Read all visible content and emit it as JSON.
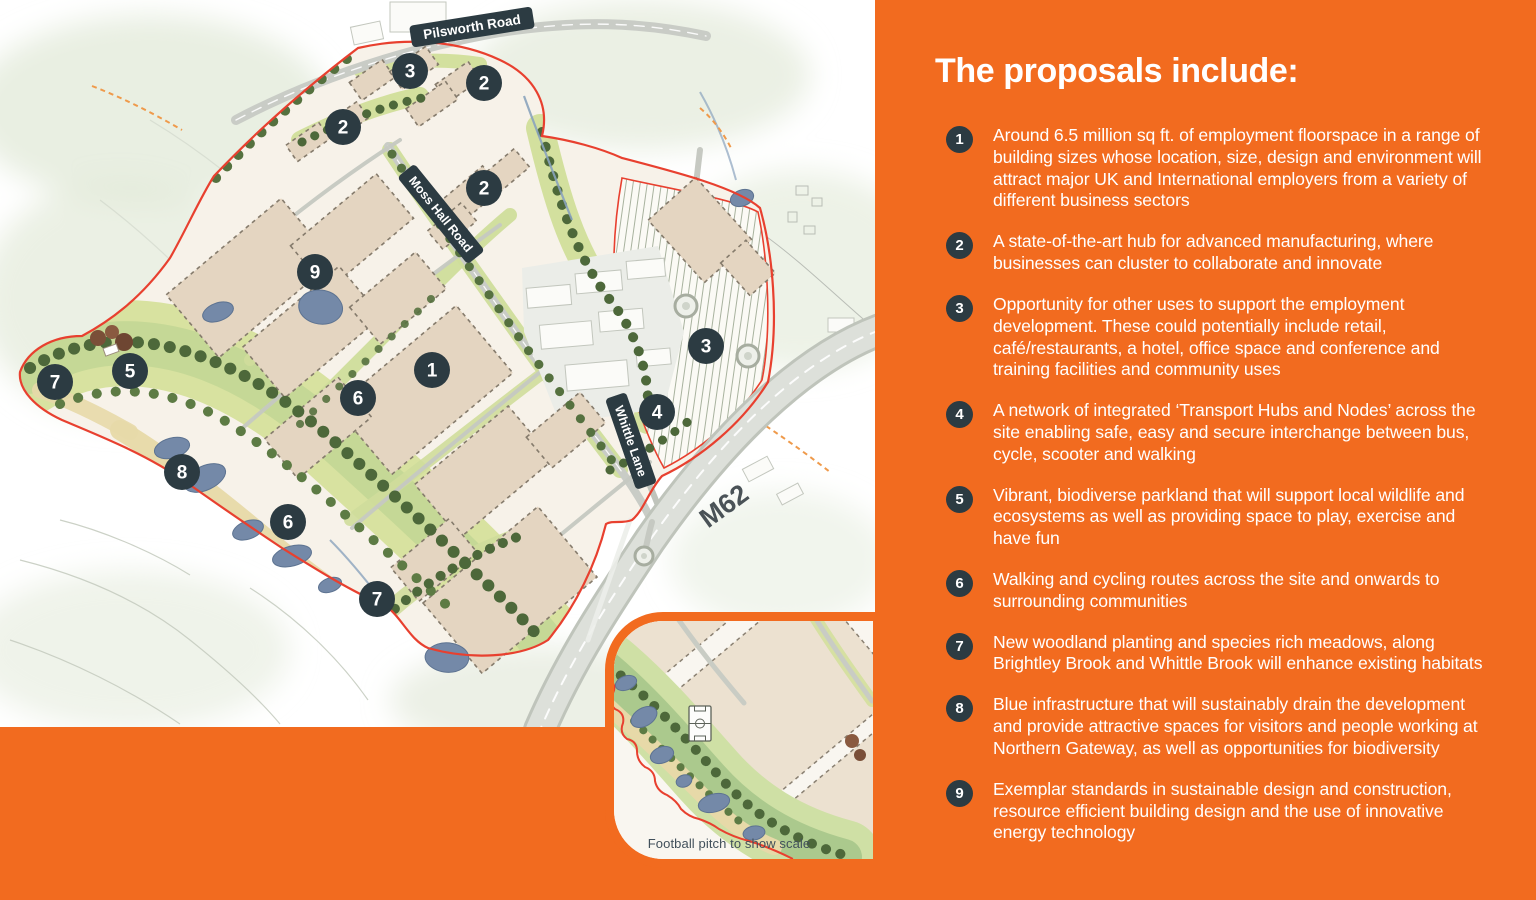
{
  "colors": {
    "accent": "#F26B1F",
    "slate": "#2C3B42",
    "boundary": "#E8402F",
    "water": "#7489A8",
    "parkland": "#D8E2A0",
    "building": "#E4D5C1"
  },
  "panel": {
    "title": "The proposals include:",
    "items": [
      {
        "number": "1",
        "text": "Around 6.5 million sq ft. of employment floorspace in a range of building sizes whose location, size, design and environment will attract major UK and International employers from a variety of different business sectors"
      },
      {
        "number": "2",
        "text": "A state-of-the-art hub for advanced manufacturing, where businesses can cluster to collaborate and innovate"
      },
      {
        "number": "3",
        "text": "Opportunity for other uses to support the employment development. These could potentially include retail, café/restaurants, a hotel, office space and conference and training facilities and community uses"
      },
      {
        "number": "4",
        "text": "A network of integrated ‘Transport Hubs and Nodes’ across the site enabling safe, easy and secure interchange between bus, cycle, scooter and walking"
      },
      {
        "number": "5",
        "text": "Vibrant, biodiverse parkland that will support local wildlife and ecosystems as well as providing space to play, exercise and have fun"
      },
      {
        "number": "6",
        "text": "Walking and cycling routes across the site and onwards to surrounding communities"
      },
      {
        "number": "7",
        "text": "New woodland planting and species rich meadows, along Brightley Brook and Whittle Brook will enhance existing habitats"
      },
      {
        "number": "8",
        "text": "Blue infrastructure that will sustainably drain the development and provide attractive spaces for visitors and people working at Northern Gateway, as well as opportunities for biodiversity"
      },
      {
        "number": "9",
        "text": "Exemplar standards in sustainable design and construction, resource efficient building design and the use of innovative energy technology"
      }
    ]
  },
  "map": {
    "road_labels": [
      {
        "name": "Pilsworth Road",
        "badge": true,
        "x": 472,
        "y": 27,
        "rot": -9,
        "w": 124,
        "font": 13.5
      },
      {
        "name": "Moss Hall Road",
        "badge": true,
        "x": 441,
        "y": 214,
        "rot": 51,
        "w": 112,
        "font": 12.5
      },
      {
        "name": "Whittle Lane",
        "badge": true,
        "x": 631,
        "y": 441,
        "rot": 71,
        "w": 96,
        "font": 12.5
      },
      {
        "name": "M62",
        "badge": false,
        "x": 724,
        "y": 506,
        "rot": -36,
        "w": 0,
        "font": 27
      }
    ],
    "markers": [
      {
        "label": "3",
        "x": 410,
        "y": 71
      },
      {
        "label": "2",
        "x": 484,
        "y": 83
      },
      {
        "label": "2",
        "x": 343,
        "y": 127
      },
      {
        "label": "2",
        "x": 484,
        "y": 188
      },
      {
        "label": "9",
        "x": 315,
        "y": 272
      },
      {
        "label": "1",
        "x": 432,
        "y": 370
      },
      {
        "label": "6",
        "x": 358,
        "y": 398
      },
      {
        "label": "5",
        "x": 130,
        "y": 371
      },
      {
        "label": "7",
        "x": 55,
        "y": 382
      },
      {
        "label": "8",
        "x": 182,
        "y": 472
      },
      {
        "label": "6",
        "x": 288,
        "y": 522
      },
      {
        "label": "7",
        "x": 377,
        "y": 599
      },
      {
        "label": "3",
        "x": 706,
        "y": 346
      },
      {
        "label": "4",
        "x": 657,
        "y": 412
      }
    ],
    "inset_caption": "Football pitch to show scale"
  }
}
